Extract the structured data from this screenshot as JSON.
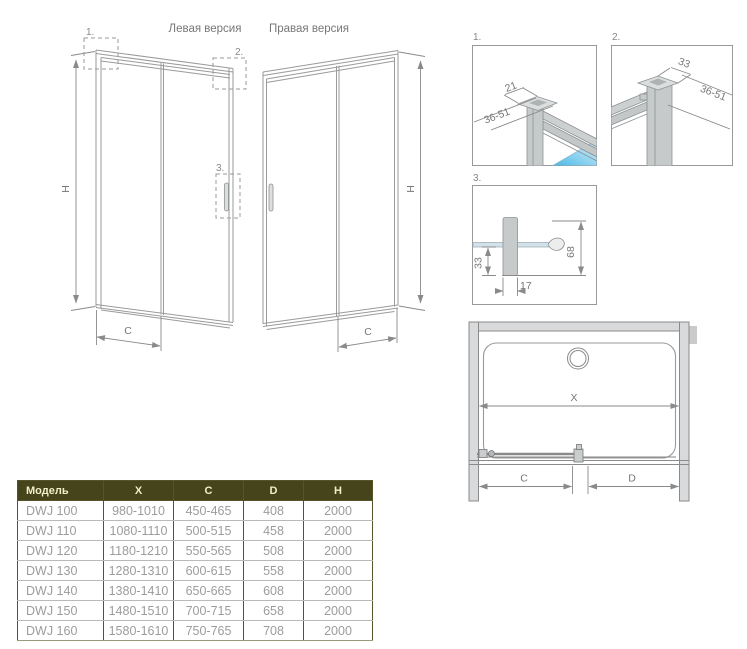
{
  "titles": {
    "left_version": "Левая версия",
    "right_version": "Правая версия"
  },
  "dims": {
    "h": "H",
    "c": "C",
    "x": "X",
    "d": "D"
  },
  "markers": {
    "m1": "1.",
    "m2": "2.",
    "m3": "3."
  },
  "details": {
    "d1": {
      "label": "1.",
      "dim_width": "21",
      "dim_range": "36-51"
    },
    "d2": {
      "label": "2.",
      "dim_width": "33",
      "dim_range": "36-51"
    },
    "d3": {
      "label": "3.",
      "dim_depth": "33",
      "dim_height": "68",
      "dim_thickness": "17"
    }
  },
  "table": {
    "headers": [
      "Модель",
      "X",
      "C",
      "D",
      "H"
    ],
    "rows": [
      [
        "DWJ 100",
        "980-1010",
        "450-465",
        "408",
        "2000"
      ],
      [
        "DWJ 110",
        "1080-1110",
        "500-515",
        "458",
        "2000"
      ],
      [
        "DWJ 120",
        "1180-1210",
        "550-565",
        "508",
        "2000"
      ],
      [
        "DWJ 130",
        "1280-1310",
        "600-615",
        "558",
        "2000"
      ],
      [
        "DWJ 140",
        "1380-1410",
        "650-665",
        "608",
        "2000"
      ],
      [
        "DWJ 150",
        "1480-1510",
        "700-715",
        "658",
        "2000"
      ],
      [
        "DWJ 160",
        "1580-1610",
        "750-765",
        "708",
        "2000"
      ]
    ]
  },
  "colors": {
    "header_bg": "#45441b",
    "header_text": "#f2efc8",
    "body_text": "#9c9c9c",
    "grid_dark": "#55542a",
    "grid_light": "#b9b9b9",
    "drawing_line": "#9a9a9a",
    "dim_line": "#8a8a8a",
    "label_text": "#777777",
    "profile_fill": "#c6cacb",
    "glass_blue": "#47b7e6",
    "wall_fill": "#d9dadb"
  }
}
